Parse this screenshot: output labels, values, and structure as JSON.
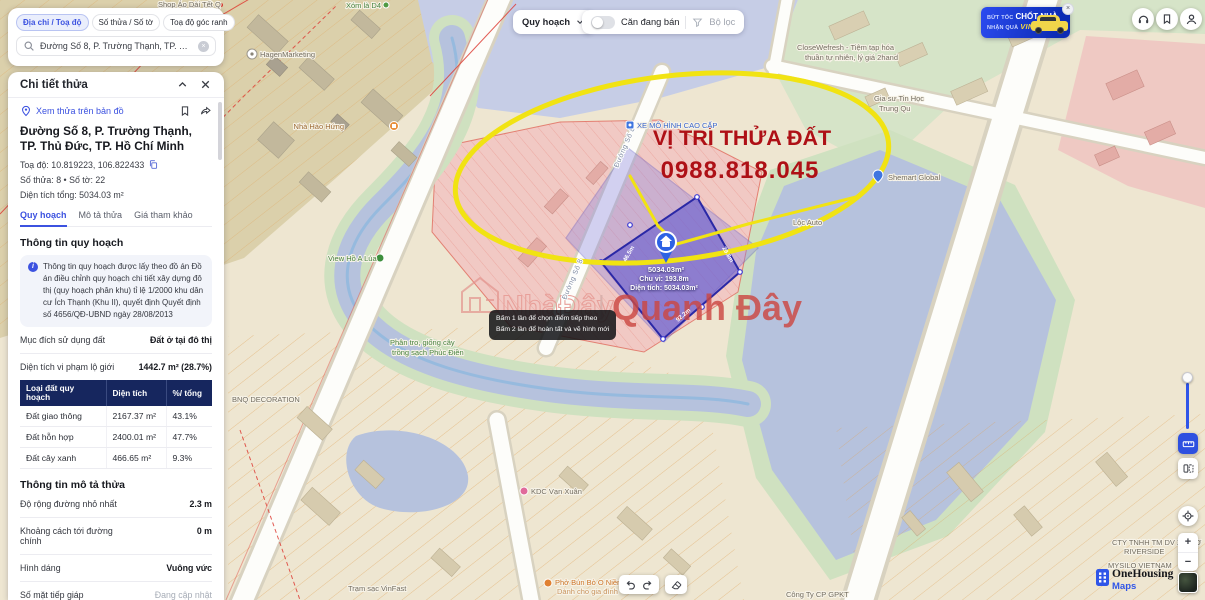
{
  "colors": {
    "accent": "#3c52e0",
    "table_header": "#16265e",
    "annotation_red": "#ae1016",
    "highlight_yellow": "#f1e312",
    "parcel_purple": "#5b54cf"
  },
  "icons": {
    "close": "×",
    "plus": "+",
    "minus": "−",
    "pipe": "|",
    "info": "i"
  },
  "search_card": {
    "tabs": [
      "Địa chỉ / Toạ độ",
      "Số thửa / Số tờ",
      "Toạ độ góc ranh"
    ],
    "query": "Đường Số 8, P. Trường Thạnh, TP. Thủ Đức, TP..."
  },
  "toolbar": {
    "layer": "Quy hoạch",
    "toggle_label": "Căn đang bán",
    "filter_label": "Bộ lọc"
  },
  "promo": {
    "l1": "BỨT TỐC",
    "l2": "CHỐT NHÀ",
    "l3": "NHẬN QUÀ",
    "l4": "VINFAST"
  },
  "panel": {
    "header": "Chi tiết thửa",
    "view_link": "Xem thửa trên bản đồ",
    "address": "Đường Số 8, P. Trường Thạnh, TP. Thủ Đức, TP. Hồ Chí Minh",
    "coord": "Toạ độ: 10.819223, 106.822433",
    "parcel_info": "Số thửa: 8  •  Số tờ: 22",
    "area_total": "Diện tích tổng: 5034.03 m²",
    "tabs": [
      "Quy hoạch",
      "Mô tả thửa",
      "Giá tham khảo"
    ],
    "planning_heading": "Thông tin quy hoạch",
    "notice": "Thông tin quy hoạch được lấy theo đồ án Đồ án điều chỉnh quy hoạch chi tiết xây dựng đô thị (quy hoạch phân khu) tỉ lệ 1/2000 khu dân cư Ích Thạnh (Khu II), quyết định Quyết định số 4656/QĐ-UBND ngày 28/08/2013",
    "kv": [
      {
        "label": "Mục đích sử dụng đất",
        "value": "Đất ở tại đô thị"
      },
      {
        "label": "Diện tích vi phạm lộ giới",
        "value": "1442.7 m² (28.7%)"
      }
    ],
    "table": {
      "headers": [
        "Loại đất quy hoạch",
        "Diện tích",
        "%/ tổng"
      ],
      "rows": [
        [
          "Đất giao thông",
          "2167.37 m²",
          "43.1%"
        ],
        [
          "Đất hỗn hợp",
          "2400.01 m²",
          "47.7%"
        ],
        [
          "Đất cây xanh",
          "466.65 m²",
          "9.3%"
        ]
      ]
    },
    "desc_heading": "Thông tin mô tả thửa",
    "desc": [
      {
        "label": "Độ rộng đường nhỏ nhất",
        "value": "2.3 m"
      },
      {
        "label": "Khoảng cách tới đường chính",
        "value": "0 m"
      },
      {
        "label": "Hình dáng",
        "value": "Vuông vức"
      },
      {
        "label": "Số mặt tiếp giáp",
        "value": "Đang cập nhật"
      }
    ]
  },
  "annotation": {
    "title": "VỊ TRÍ THỬA ĐẤT",
    "phone": "0988.818.045"
  },
  "parcel": {
    "pin_area": "5034.03m²",
    "perimeter": "Chu vi: 193.8m",
    "area_line": "Diện tích: 5034.03m²",
    "dims": [
      "46.5m",
      "29.8m",
      "92.2m"
    ]
  },
  "tooltip": {
    "l1": "Bấm 1 lần để chọn điểm tiếp theo",
    "l2": "Bấm 2 lần để hoàn tất và vẽ hình mới"
  },
  "watermark": {
    "left": "NhàĐây",
    "right": "Quanh Đây"
  },
  "street": {
    "name": "Đường Số 8"
  },
  "pois": [
    {
      "label": "Shop Áo Dài Tết Q"
    },
    {
      "label": "Xóm là D4"
    },
    {
      "label": "HagenMarketing"
    },
    {
      "label": "Nhà Hào Hứng"
    },
    {
      "label": "XE MÔ HÌNH CAO CẤP"
    },
    {
      "label": "CloseWefresh - Tiệm tạp hóa"
    },
    {
      "label": "thuần tự nhiên, lý giá 2hand"
    },
    {
      "label": "Gia sư Tin Học"
    },
    {
      "label": "Trung Qu"
    },
    {
      "label": "Shemart Global"
    },
    {
      "label": "Lộc Auto"
    },
    {
      "label": "View Hồ A Lúa"
    },
    {
      "label": "Phân tro, giống cây"
    },
    {
      "label": "trồng sạch Phúc Điền"
    },
    {
      "label": "BNQ DECORATION"
    },
    {
      "label": "KDC Vạn Xuân"
    },
    {
      "label": "Phở Bún Bò O Niềm"
    },
    {
      "label": "Dành cho gia đình"
    },
    {
      "label": "Trạm sạc VinFast"
    },
    {
      "label": "Công Ty CP GPKT"
    },
    {
      "label": "MYSILO VIETNAM"
    },
    {
      "label": "CTY TNHH TM DV XD CƠ"
    },
    {
      "label": "RIVERSIDE"
    }
  ],
  "attribution": {
    "brand": "OneHousing",
    "sub": "Maps"
  }
}
